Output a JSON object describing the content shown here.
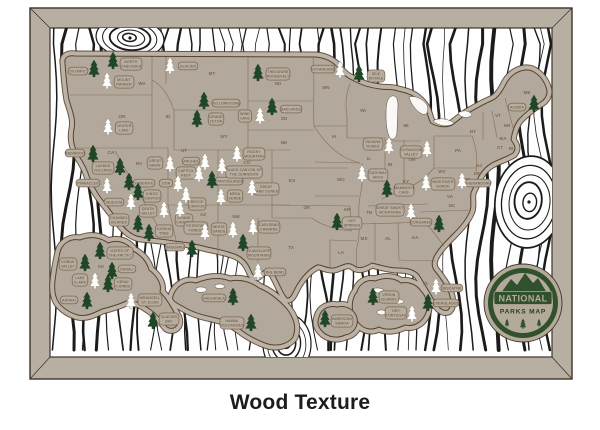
{
  "product": {
    "caption": "Wood Texture",
    "badge": {
      "line1": "NATIONAL",
      "line2": "PARKS MAP"
    }
  },
  "colors": {
    "frame": "#b8afa3",
    "frame_line": "#3f3428",
    "board": "#fefefe",
    "grain": "#1b1b1b",
    "map": "#b2a89b",
    "map_halo": "#bcb3a6",
    "outline": "#55432f",
    "state_line": "#7d6850",
    "state_text": "#6d5941",
    "pill_fill": "#b7ad9f",
    "pill_stroke": "#6f5a44",
    "label_text": "#5f4c39",
    "tree_green": "#1d4727",
    "tree_green_line": "#0f2a14",
    "tree_white": "#fdfdfb",
    "tree_white_line": "#a39a8d",
    "badge_green": "#31502c",
    "badge_tan": "#b3aa9b",
    "badge_text_dark": "#24401f"
  },
  "states": [
    [
      "WA",
      142,
      85
    ],
    [
      "OR",
      122,
      118
    ],
    [
      "CA",
      111,
      154
    ],
    [
      "NV",
      139,
      165
    ],
    [
      "ID",
      168,
      118
    ],
    [
      "MT",
      212,
      75
    ],
    [
      "WY",
      224,
      138
    ],
    [
      "UT",
      184,
      152
    ],
    [
      "AZ",
      203,
      216
    ],
    [
      "CO",
      247,
      164
    ],
    [
      "NM",
      236,
      218
    ],
    [
      "ND",
      278,
      85
    ],
    [
      "SD",
      284,
      120
    ],
    [
      "NE",
      284,
      144
    ],
    [
      "KS",
      292,
      182
    ],
    [
      "OK",
      307,
      209
    ],
    [
      "TX",
      291,
      249
    ],
    [
      "MN",
      326,
      89
    ],
    [
      "IA",
      334,
      138
    ],
    [
      "MO",
      341,
      181
    ],
    [
      "AR",
      347,
      211
    ],
    [
      "LA",
      341,
      254
    ],
    [
      "WI",
      363,
      112
    ],
    [
      "IL",
      369,
      160
    ],
    [
      "MI",
      406,
      127
    ],
    [
      "IN",
      390,
      166
    ],
    [
      "OH",
      412,
      161
    ],
    [
      "KY",
      406,
      183
    ],
    [
      "TN",
      369,
      214
    ],
    [
      "MS",
      364,
      240
    ],
    [
      "AL",
      388,
      240
    ],
    [
      "GA",
      415,
      239
    ],
    [
      "FL",
      426,
      285
    ],
    [
      "SC",
      437,
      228
    ],
    [
      "NC",
      452,
      207
    ],
    [
      "VA",
      450,
      198
    ],
    [
      "WV",
      442,
      173
    ],
    [
      "PA",
      458,
      152
    ],
    [
      "NY",
      473,
      133
    ],
    [
      "NJ",
      479,
      167
    ],
    [
      "MD",
      467,
      181
    ],
    [
      "DE",
      477,
      175
    ],
    [
      "CT",
      500,
      149
    ],
    [
      "RI",
      511,
      150
    ],
    [
      "MA",
      503,
      140
    ],
    [
      "VT",
      498,
      117
    ],
    [
      "NH",
      507,
      127
    ],
    [
      "ME",
      527,
      94
    ],
    [
      "AK",
      101,
      268
    ]
  ],
  "parks": [
    {
      "n": "Olympic",
      "tree": "green",
      "t": [
        94,
        69
      ],
      "p": [
        78,
        71
      ],
      "l": [
        "OLYMPIC"
      ]
    },
    {
      "n": "North Cascades",
      "tree": "green",
      "t": [
        113,
        61
      ],
      "p": [
        131,
        64
      ],
      "l": [
        "NORTH",
        "CASCADES"
      ]
    },
    {
      "n": "Mount Rainier",
      "tree": "white",
      "t": [
        107,
        81
      ],
      "p": [
        124,
        82
      ],
      "l": [
        "MOUNT",
        "RAINIER"
      ]
    },
    {
      "n": "Glacier",
      "tree": "white",
      "t": [
        170,
        66
      ],
      "p": [
        188,
        66
      ],
      "l": [
        "GLACIER"
      ]
    },
    {
      "n": "Theodore Roosevelt",
      "tree": "green",
      "t": [
        258,
        73
      ],
      "p": [
        278,
        74
      ],
      "l": [
        "THEODORE",
        "ROOSEVELT"
      ]
    },
    {
      "n": "Yellowstone",
      "tree": "green",
      "t": [
        204,
        101
      ],
      "p": [
        226,
        103
      ],
      "l": [
        "YELLOWSTONE"
      ]
    },
    {
      "n": "Grand Teton",
      "tree": "green",
      "t": [
        197,
        119
      ],
      "p": [
        216,
        119
      ],
      "l": [
        "GRAND",
        "TETON"
      ]
    },
    {
      "n": "Wind Cave",
      "tree": "white",
      "t": [
        260,
        116
      ],
      "p": [
        245,
        116
      ],
      "l": [
        "WIND",
        "CAVE"
      ]
    },
    {
      "n": "Badlands",
      "tree": "green",
      "t": [
        272,
        107
      ],
      "p": [
        291,
        109
      ],
      "l": [
        "BADLANDS"
      ]
    },
    {
      "n": "Crater Lake",
      "tree": "white",
      "t": [
        108,
        127
      ],
      "p": [
        124,
        128
      ],
      "l": [
        "CRATER",
        "LAKE"
      ]
    },
    {
      "n": "Redwood",
      "tree": "green",
      "t": [
        93,
        154
      ],
      "p": [
        75,
        153
      ],
      "l": [
        "REDWOOD"
      ]
    },
    {
      "n": "Lassen Volcanic",
      "tree": "green",
      "t": [
        120,
        167
      ],
      "p": [
        103,
        168
      ],
      "l": [
        "LASSEN",
        "VOLCANIC"
      ]
    },
    {
      "n": "Pinnacles",
      "tree": "white",
      "t": [
        107,
        186
      ],
      "p": [
        88,
        183
      ],
      "l": [
        "PINNACLES"
      ]
    },
    {
      "n": "Yosemite",
      "tree": "green",
      "t": [
        129,
        182
      ],
      "p": [
        144,
        183
      ],
      "l": [
        "YOSEMITE"
      ]
    },
    {
      "n": "Kings Canyon",
      "tree": "green",
      "t": [
        138,
        192
      ],
      "p": [
        152,
        196
      ],
      "l": [
        "KINGS",
        "CANYON"
      ]
    },
    {
      "n": "Sequoia",
      "tree": "white",
      "t": [
        131,
        202
      ],
      "p": [
        114,
        202
      ],
      "l": [
        "SEQUOIA"
      ]
    },
    {
      "n": "Death Valley",
      "tree": "white",
      "t": [
        164,
        210
      ],
      "p": [
        148,
        211
      ],
      "l": [
        "DEATH",
        "VALLEY"
      ]
    },
    {
      "n": "Channel Islands",
      "tree": "green",
      "t": [
        138,
        224
      ],
      "p": [
        119,
        220
      ],
      "l": [
        "CHANNEL",
        "ISLANDS"
      ]
    },
    {
      "n": "Joshua Tree",
      "tree": "green",
      "t": [
        149,
        233
      ],
      "p": [
        164,
        231
      ],
      "l": [
        "JOSHUA",
        "TREE"
      ]
    },
    {
      "n": "Great Basin",
      "tree": "white",
      "t": [
        170,
        164
      ],
      "p": [
        155,
        163
      ],
      "l": [
        "GREAT",
        "BASIN"
      ]
    },
    {
      "n": "Arches",
      "tree": "white",
      "t": [
        205,
        162
      ],
      "p": [
        191,
        161
      ],
      "l": [
        "ARCHES"
      ]
    },
    {
      "n": "Capitol Reef",
      "tree": "white",
      "t": [
        199,
        174
      ],
      "p": [
        186,
        173
      ],
      "l": [
        "CAPITOL",
        "REEF"
      ]
    },
    {
      "n": "Zion",
      "tree": "white",
      "t": [
        178,
        184
      ],
      "p": [
        166,
        183
      ],
      "l": [
        "ZION"
      ]
    },
    {
      "n": "Bryce Canyon",
      "tree": "white",
      "t": [
        186,
        195
      ],
      "p": [
        197,
        204
      ],
      "l": [
        "BRYCE",
        "CANYON"
      ]
    },
    {
      "n": "Grand Canyon",
      "tree": "white",
      "t": [
        180,
        209
      ],
      "p": [
        184,
        220
      ],
      "l": [
        "GRAND",
        "CANYON"
      ]
    },
    {
      "n": "Petrified Forest",
      "tree": "white",
      "t": [
        205,
        232
      ],
      "p": [
        196,
        228
      ],
      "l": [
        "PETRIFIED",
        "FOREST"
      ]
    },
    {
      "n": "Saguaro",
      "tree": "green",
      "t": [
        192,
        249
      ],
      "p": [
        175,
        247
      ],
      "l": [
        "SAGUARO"
      ]
    },
    {
      "n": "White Sands",
      "tree": "white",
      "t": [
        233,
        230
      ],
      "p": [
        219,
        229
      ],
      "l": [
        "WHITE",
        "SANDS"
      ]
    },
    {
      "n": "Carlsbad Caverns",
      "tree": "white",
      "t": [
        253,
        227
      ],
      "p": [
        269,
        227
      ],
      "l": [
        "CARLSBAD",
        "CAVERNS"
      ]
    },
    {
      "n": "Guadalupe Mountains",
      "tree": "green",
      "t": [
        243,
        243
      ],
      "p": [
        259,
        253
      ],
      "l": [
        "GUADALUPE",
        "MOUNTAINS"
      ]
    },
    {
      "n": "Big Bend",
      "tree": "white",
      "t": [
        258,
        272
      ],
      "p": [
        275,
        272
      ],
      "l": [
        "BIG BEND"
      ]
    },
    {
      "n": "Great Sand Dunes",
      "tree": "white",
      "t": [
        252,
        188
      ],
      "p": [
        266,
        189
      ],
      "l": [
        "GREAT",
        "SAND DUNES"
      ]
    },
    {
      "n": "Mesa Verde",
      "tree": "white",
      "t": [
        221,
        197
      ],
      "p": [
        235,
        196
      ],
      "l": [
        "MESA",
        "VERDE"
      ]
    },
    {
      "n": "Canyonlands",
      "tree": "green",
      "t": [
        212,
        180
      ],
      "p": [
        229,
        181
      ],
      "l": [
        "CANYONLANDS"
      ]
    },
    {
      "n": "Black Canyon of the Gunnison",
      "tree": "white",
      "t": [
        222,
        166
      ],
      "p": [
        244,
        172
      ],
      "l": [
        "BLACK CANYON OF",
        "THE GUNNISON"
      ]
    },
    {
      "n": "Rocky Mountain",
      "tree": "white",
      "t": [
        237,
        154
      ],
      "p": [
        254,
        154
      ],
      "l": [
        "ROCKY",
        "MOUNTAIN"
      ]
    },
    {
      "n": "Voyageurs",
      "tree": "white",
      "t": [
        340,
        70
      ],
      "p": [
        323,
        69
      ],
      "l": [
        "VOYAGEURS"
      ]
    },
    {
      "n": "Isle Royale",
      "tree": "green",
      "t": [
        359,
        74
      ],
      "p": [
        376,
        76
      ],
      "l": [
        "ISLE",
        "ROYALE"
      ]
    },
    {
      "n": "Indiana Dunes",
      "tree": "white",
      "t": [
        389,
        146
      ],
      "p": [
        373,
        144
      ],
      "l": [
        "INDIANA",
        "DUNES"
      ]
    },
    {
      "n": "Cuyahoga Valley",
      "tree": "white",
      "t": [
        427,
        149
      ],
      "p": [
        411,
        152
      ],
      "l": [
        "CUYAHOGA",
        "VALLEY"
      ]
    },
    {
      "n": "Gateway Arch",
      "tree": "white",
      "t": [
        362,
        174
      ],
      "p": [
        378,
        175
      ],
      "l": [
        "GATEWAY",
        "ARCH"
      ]
    },
    {
      "n": "Mammoth Cave",
      "tree": "green",
      "t": [
        387,
        189
      ],
      "p": [
        404,
        190
      ],
      "l": [
        "MAMMOTH",
        "CAVE"
      ]
    },
    {
      "n": "New River Gorge",
      "tree": "white",
      "t": [
        426,
        183
      ],
      "p": [
        443,
        184
      ],
      "l": [
        "NEW RIVER",
        "GORGE"
      ]
    },
    {
      "n": "Shenandoah",
      "tree": "white",
      "t": [
        462,
        181
      ],
      "p": [
        478,
        183
      ],
      "l": [
        "SHENANDOAH"
      ]
    },
    {
      "n": "Great Smoky Mountains",
      "tree": "white",
      "t": [
        411,
        212
      ],
      "p": [
        390,
        210
      ],
      "l": [
        "GREAT SMOKY",
        "MOUNTAINS"
      ]
    },
    {
      "n": "Congaree",
      "tree": "green",
      "t": [
        439,
        224
      ],
      "p": [
        421,
        222
      ],
      "l": [
        "CONGAREE"
      ]
    },
    {
      "n": "Hot Springs",
      "tree": "green",
      "t": [
        337,
        222
      ],
      "p": [
        352,
        223
      ],
      "l": [
        "HOT",
        "SPRINGS"
      ]
    },
    {
      "n": "Acadia",
      "tree": "green",
      "t": [
        534,
        104
      ],
      "p": [
        517,
        107
      ],
      "l": [
        "ACADIA"
      ]
    },
    {
      "n": "Gates of the Arctic",
      "tree": "green",
      "t": [
        100,
        251
      ],
      "p": [
        120,
        253
      ],
      "l": [
        "GATES OF",
        "THE ARCTIC"
      ]
    },
    {
      "n": "Kobuk Valley",
      "tree": "green",
      "t": [
        85,
        263
      ],
      "p": [
        68,
        264
      ],
      "l": [
        "KOBUK",
        "VALLEY"
      ]
    },
    {
      "n": "Denali",
      "tree": "green",
      "t": [
        112,
        271
      ],
      "p": [
        127,
        269
      ],
      "l": [
        "DENALI"
      ]
    },
    {
      "n": "Lake Clark",
      "tree": "white",
      "t": [
        95,
        281
      ],
      "p": [
        80,
        280
      ],
      "l": [
        "LAKE",
        "CLARK"
      ]
    },
    {
      "n": "Kenai Fjords",
      "tree": "green",
      "t": [
        108,
        284
      ],
      "p": [
        123,
        284
      ],
      "l": [
        "KENAI",
        "FJORDS"
      ]
    },
    {
      "n": "Katmai",
      "tree": "green",
      "t": [
        87,
        301
      ],
      "p": [
        69,
        300
      ],
      "l": [
        "KATMAI"
      ]
    },
    {
      "n": "Wrangell-St. Elias",
      "tree": "white",
      "t": [
        131,
        301
      ],
      "p": [
        150,
        300
      ],
      "l": [
        "WRANGELL",
        "ST. ELIAS"
      ]
    },
    {
      "n": "Glacier Bay",
      "tree": "green",
      "t": [
        153,
        321
      ],
      "p": [
        169,
        319
      ],
      "l": [
        "GLACIER",
        "BAY"
      ]
    },
    {
      "n": "Haleakala",
      "tree": "green",
      "t": [
        233,
        297
      ],
      "p": [
        214,
        298
      ],
      "l": [
        "HALEAKALA"
      ]
    },
    {
      "n": "Hawaii Volcanoes",
      "tree": "green",
      "t": [
        251,
        323
      ],
      "p": [
        232,
        323
      ],
      "l": [
        "HAWAII",
        "VOLCANOES"
      ]
    },
    {
      "n": "Virgin Islands",
      "tree": "green",
      "t": [
        373,
        297
      ],
      "p": [
        389,
        297
      ],
      "l": [
        "VIRGIN",
        "ISLANDS"
      ]
    },
    {
      "n": "Dry Tortugas",
      "tree": "white",
      "t": [
        412,
        314
      ],
      "p": [
        396,
        313
      ],
      "l": [
        "DRY",
        "TORTUGAS"
      ]
    },
    {
      "n": "Biscayne",
      "tree": "white",
      "t": [
        436,
        287
      ],
      "p": [
        452,
        288
      ],
      "l": [
        "BISCAYNE"
      ]
    },
    {
      "n": "Everglades",
      "tree": "green",
      "t": [
        428,
        303
      ],
      "p": [
        446,
        303
      ],
      "l": [
        "EVERGLADES"
      ]
    },
    {
      "n": "American Samoa",
      "tree": "green",
      "t": [
        325,
        319
      ],
      "p": [
        342,
        321
      ],
      "l": [
        "AMERICAN",
        "SAMOA"
      ]
    }
  ]
}
